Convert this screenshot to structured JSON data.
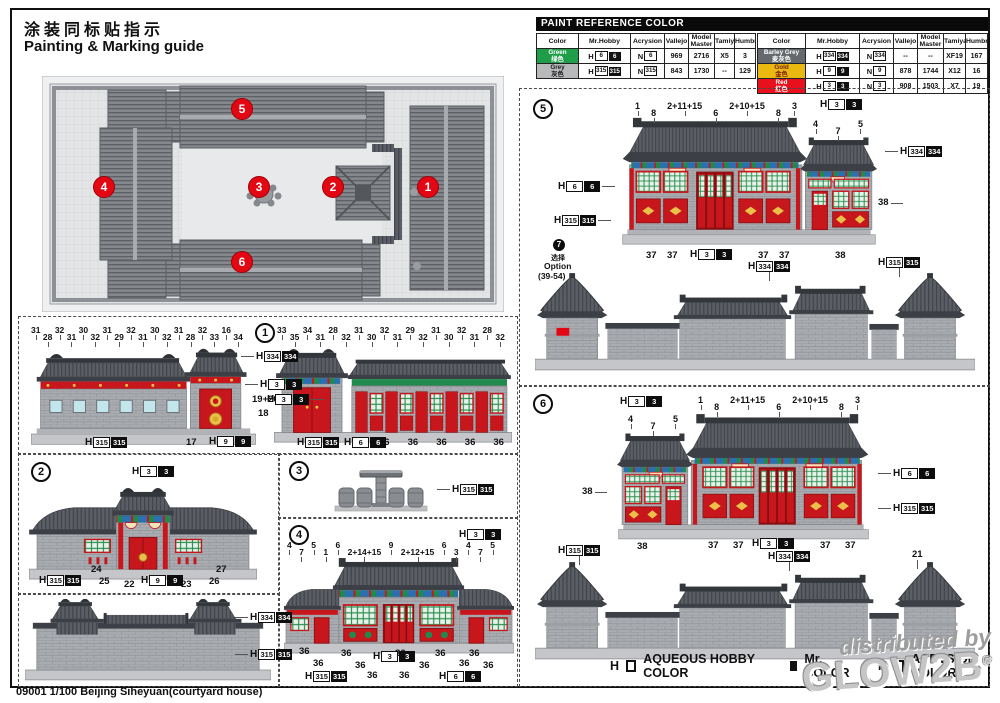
{
  "page": {
    "title_zh": "涂装同标贴指示",
    "title_en": "Painting & Marking guide",
    "footer": "09001 1/100 Beijing Siheyuan(courtyard house)"
  },
  "colors": {
    "accent_red": "#e30613",
    "green": "#1f9d49",
    "grey": "#b7b9bb",
    "barley_grey": "#65696d",
    "gold": "#eab90f",
    "roof_grey": "#5b5f65",
    "facade_red": "#c8161d"
  },
  "paint_table": {
    "header": "PAINT REFERENCE COLOR",
    "columns": [
      "Color",
      "Mr.Hobby",
      "Acrysion",
      "Vallejo",
      "Model Master",
      "Tamiya",
      "Humbrol"
    ],
    "left_rows": [
      {
        "name_en": "Green",
        "name_zh": "绿色",
        "style": "background:#1f9d49;color:#ffffff",
        "h": "6",
        "mr": "6",
        "n": "6",
        "vallejo": "969",
        "mm": "2716",
        "tamiya": "X5",
        "humbrol": "3"
      },
      {
        "name_en": "Grey",
        "name_zh": "灰色",
        "style": "background:#b7b9bb;color:#1a1a1a",
        "h": "315",
        "mr": "315",
        "n": "315",
        "vallejo": "843",
        "mm": "1730",
        "tamiya": "--",
        "humbrol": "129"
      }
    ],
    "right_rows": [
      {
        "name_en": "Barley Grey",
        "name_zh": "麦灰色",
        "style": "background:#65696d;color:#ffffff",
        "h": "334",
        "mr": "334",
        "n": "334",
        "vallejo": "--",
        "mm": "--",
        "tamiya": "XF19",
        "humbrol": "167"
      },
      {
        "name_en": "Gold",
        "name_zh": "金色",
        "style": "background:#eab90f;color:#7a1d00",
        "h": "9",
        "mr": "9",
        "n": "9",
        "vallejo": "878",
        "mm": "1744",
        "tamiya": "X12",
        "humbrol": "16"
      },
      {
        "name_en": "Red",
        "name_zh": "红色",
        "style": "background:#e8101c;color:#ffffff",
        "h": "3",
        "mr": "3",
        "n": "3",
        "vallejo": "908",
        "mm": "1503",
        "tamiya": "X7",
        "humbrol": "19"
      }
    ]
  },
  "legend": {
    "h": "H",
    "n": "N",
    "aqueous": "AQUEOUS HOBBY COLOR",
    "mr": "Mr. COLOR",
    "acrysion": "ACRYSION COLOR"
  },
  "chips": {
    "c3": "3",
    "c6": "6",
    "c9": "9",
    "c315": "315",
    "c334": "334"
  },
  "plan": {
    "badges": [
      "1",
      "2",
      "3",
      "4",
      "5",
      "6"
    ]
  },
  "s1": {
    "badge": "1",
    "a_top": [
      "31",
      "28",
      "32",
      "31",
      "30",
      "32",
      "31",
      "29",
      "32",
      "31",
      "30",
      "32",
      "31",
      "28",
      "32",
      "33",
      "16",
      "34"
    ],
    "right": [
      "19+20",
      "18"
    ],
    "a_bottom": [
      "17"
    ],
    "b_top": [
      "33",
      "35",
      "34",
      "31",
      "28",
      "32",
      "31",
      "30",
      "32",
      "31",
      "29",
      "32",
      "31",
      "30",
      "32",
      "31",
      "28",
      "32"
    ],
    "b_bottom": [
      "36",
      "36",
      "36",
      "36",
      "36"
    ]
  },
  "s2": {
    "badge": "2",
    "nums": [
      "24",
      "25",
      "22",
      "23",
      "26",
      "27"
    ]
  },
  "s3": {
    "badge": "3"
  },
  "s4": {
    "badge": "4",
    "top": [
      "4",
      "7",
      "5",
      "1",
      "6",
      "2+14+15",
      "9",
      "2+12+15",
      "6",
      "3",
      "4",
      "7",
      "5"
    ],
    "b36": [
      "36",
      "36",
      "36",
      "36",
      "36",
      "36",
      "36",
      "36",
      "36",
      "36",
      "36",
      "36"
    ]
  },
  "s5": {
    "badge": "5",
    "top": [
      "1",
      "8",
      "2+11+15",
      "6",
      "2+10+15",
      "8",
      "3"
    ],
    "sub": [
      "4",
      "7",
      "5"
    ],
    "right38": "38",
    "b": [
      "37",
      "37"
    ],
    "b2": [
      "37",
      "37"
    ],
    "b38": "38",
    "option": {
      "badge": "7",
      "zh": "选择",
      "en": "Option",
      "range": "(39-54)"
    }
  },
  "s6": {
    "badge": "6",
    "sub": [
      "4",
      "7",
      "5"
    ],
    "top": [
      "1",
      "8",
      "2+11+15",
      "6",
      "2+10+15",
      "8",
      "3"
    ],
    "left38": "38",
    "b38": "38",
    "b": [
      "37",
      "37"
    ],
    "b2": [
      "37",
      "37"
    ],
    "n21": "21"
  },
  "watermark": {
    "line1": "distributed by",
    "line2": "GLOW2B",
    "reg": "®"
  }
}
